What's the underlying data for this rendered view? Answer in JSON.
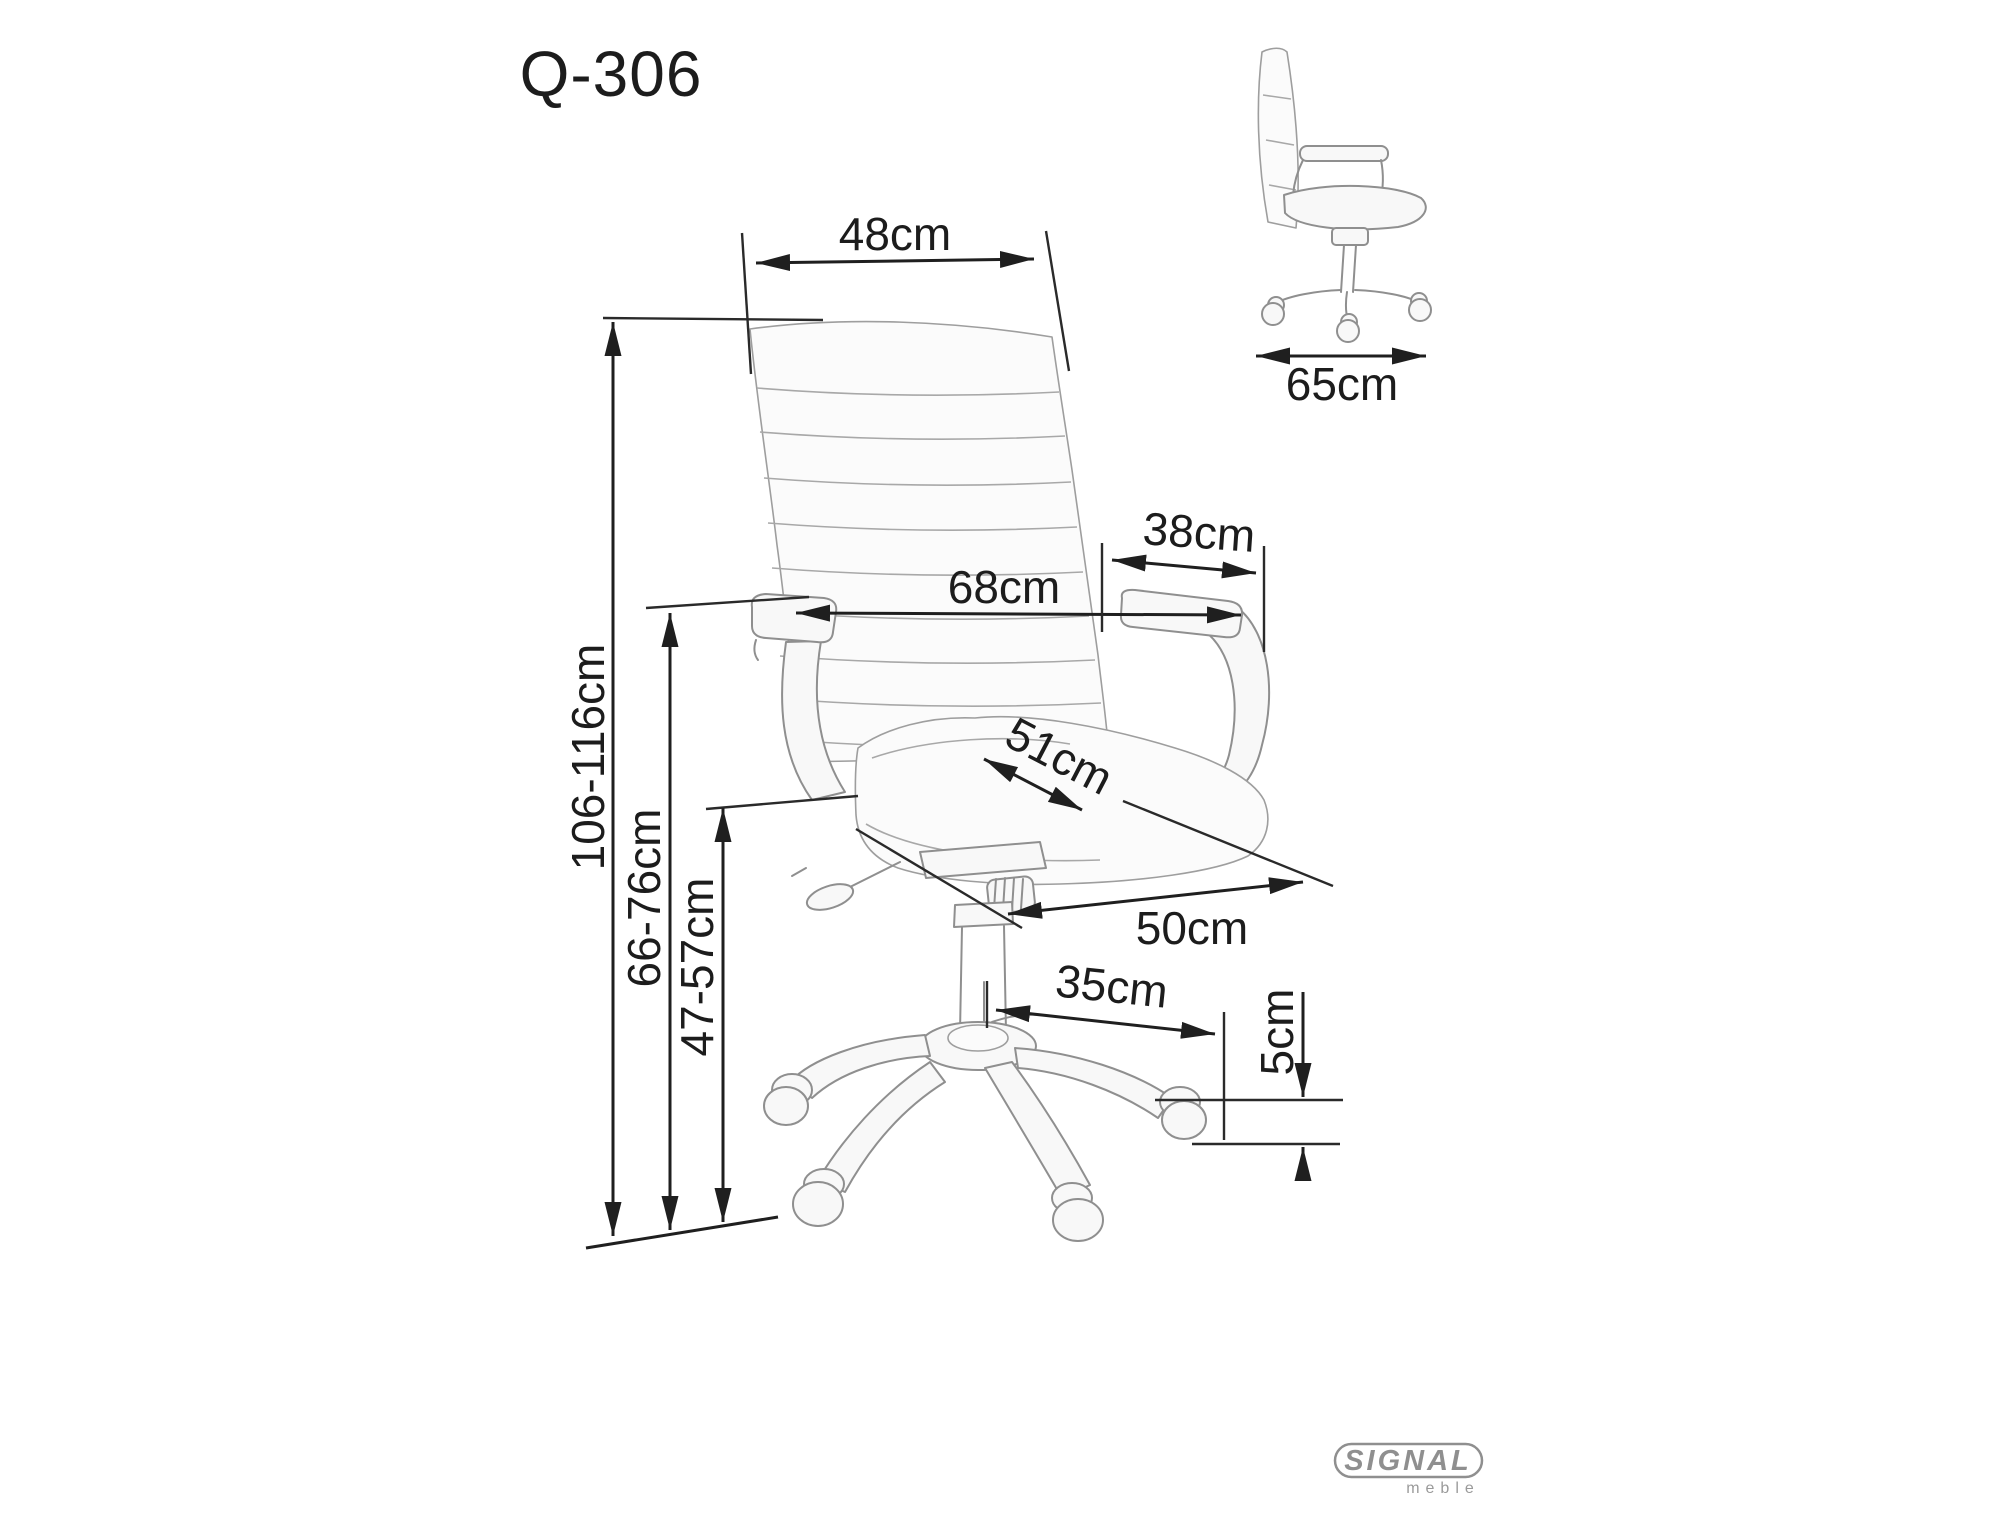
{
  "title": "Q-306",
  "dimensions": {
    "backrest_width": "48cm",
    "overall_depth": "65cm",
    "armrest_depth": "38cm",
    "overall_width": "68cm",
    "total_height": "106-116cm",
    "armrest_height": "66-76cm",
    "seat_height": "47-57cm",
    "seat_depth": "51cm",
    "seat_width": "50cm",
    "base_span": "35cm",
    "caster_height": "5cm"
  },
  "logo": {
    "brand": "SIGNAL",
    "subtitle": "meble"
  },
  "colors": {
    "dimension_line": "#1f1f1f",
    "sketch_line": "#8f8f8f",
    "logo_gray": "#8f8f8f",
    "background": "#ffffff"
  }
}
